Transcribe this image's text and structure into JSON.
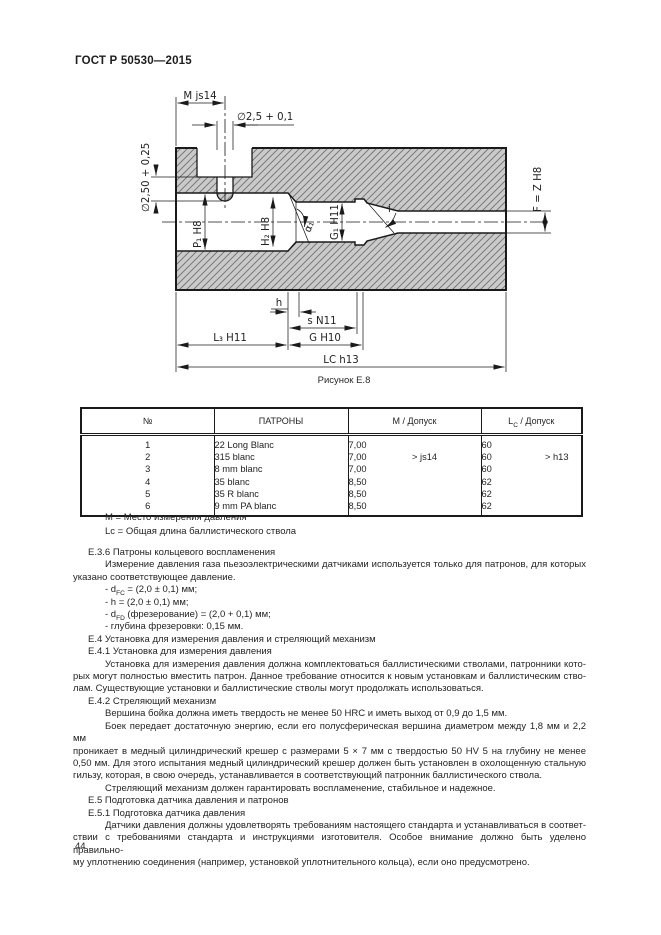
{
  "page": {
    "doc_number": "ГОСТ Р 50530—2015",
    "page_number": "44"
  },
  "figure": {
    "caption": "Рисунок Е.8",
    "labels": {
      "m_js14": "M js14",
      "hole_dia": "∅2,5 + 0,1",
      "depth_dia": "∅2,50 + 0,25",
      "p1": "P₁ H8",
      "h2": "H₂ H8",
      "alpha1": "α₁",
      "g1": "G₁ H11",
      "i": "i",
      "f": "F = Z H8",
      "h": "h",
      "s": "s N11",
      "l3": "L₃ H11",
      "g": "G H10",
      "lc": "LC h13"
    }
  },
  "table": {
    "headers": {
      "num": "№",
      "name": "ПАТРОНЫ",
      "m": "М / Допуск",
      "lc": "L[sub]C[/sub] / Допуск"
    },
    "m_tolerance": "> js14",
    "lc_tolerance": "> h13",
    "rows": [
      {
        "num": "1",
        "name": "22 Long Blanc",
        "m": "7,00",
        "lc": "60"
      },
      {
        "num": "2",
        "name": "315 blanc",
        "m": "7,00",
        "lc": "60"
      },
      {
        "num": "3",
        "name": "8 mm blanc",
        "m": "7,00",
        "lc": "60"
      },
      {
        "num": "4",
        "name": "35 blanc",
        "m": "8,50",
        "lc": "62"
      },
      {
        "num": "5",
        "name": "35 R blanc",
        "m": "8,50",
        "lc": "62"
      },
      {
        "num": "6",
        "name": "9 mm PA blanc",
        "m": "8,50",
        "lc": "62"
      }
    ]
  },
  "legend": {
    "line1": "М  = Место измерения давления",
    "line2": "Lc = Общая длина баллистического ствола"
  },
  "body": {
    "lines": [
      {
        "t": "Е.3.6  Патроны кольцевого воспламенения",
        "i": 1,
        "j": false
      },
      {
        "t": "Измерение давления газа пьезоэлектрическими датчиками используется только для патронов, для которых",
        "i": 2,
        "j": true
      },
      {
        "t": "указано соответствующее давление.",
        "i": 0,
        "j": false
      },
      {
        "t": "- d[sub]FC[/sub] = (2,0 ± 0,1) мм;",
        "i": 2,
        "j": false
      },
      {
        "t": "- h = (2,0 ± 0,1) мм;",
        "i": 2,
        "j": false
      },
      {
        "t": "- d[sub]FD[/sub] (фрезерование) = (2,0 + 0,1) мм;",
        "i": 2,
        "j": false
      },
      {
        "t": "- глубина фрезеровки: 0,15 мм.",
        "i": 2,
        "j": false
      },
      {
        "t": "Е.4  Установка для измерения давления и стреляющий механизм",
        "i": 1,
        "j": false
      },
      {
        "t": "Е.4.1  Установка для измерения давления",
        "i": 1,
        "j": false
      },
      {
        "t": "Установка для измерения давления должна комплектоваться баллистическими стволами, патронники кото-",
        "i": 2,
        "j": true
      },
      {
        "t": "рых могут полностью вместить патрон. Данное требование относится к новым установкам и баллистическим ство-",
        "i": 0,
        "j": true
      },
      {
        "t": "лам. Существующие установки и баллистические стволы могут продолжать использоваться.",
        "i": 0,
        "j": false
      },
      {
        "t": "Е.4.2  Стреляющий механизм",
        "i": 1,
        "j": false
      },
      {
        "t": "Вершина бойка должна иметь твердость не менее 50 HRC и иметь выход от 0,9 до 1,5 мм.",
        "i": 2,
        "j": false
      },
      {
        "t": "Боек передает достаточную энергию, если его полусферическая вершина диаметром между 1,8 мм и 2,2 мм",
        "i": 2,
        "j": true
      },
      {
        "t": "проникает в медный цилиндрический крешер с размерами 5 × 7 мм с твердостью 50 HV 5 на глубину не менее",
        "i": 0,
        "j": true
      },
      {
        "t": "0,50 мм. Для этого испытания медный цилиндрический крешер должен быть установлен в охолощенную стальную",
        "i": 0,
        "j": true
      },
      {
        "t": "гильзу, которая, в свою очередь, устанавливается в соответствующий патронник баллистического ствола.",
        "i": 0,
        "j": false
      },
      {
        "t": "Стреляющий механизм должен гарантировать воспламенение, стабильное и надежное.",
        "i": 2,
        "j": false
      },
      {
        "t": "Е.5  Подготовка датчика давления и патронов",
        "i": 1,
        "j": false
      },
      {
        "t": "Е.5.1  Подготовка датчика давления",
        "i": 1,
        "j": false
      },
      {
        "t": "Датчики давления должны удовлетворять требованиям настоящего стандарта и устанавливаться в соответ-",
        "i": 2,
        "j": true
      },
      {
        "t": "ствии с требованиями стандарта и инструкциями изготовителя. Особое внимание должно быть уделено правильно-",
        "i": 0,
        "j": true
      },
      {
        "t": "му уплотнению соединения (например, установкой уплотнительного кольца), если оно предусмотрено.",
        "i": 0,
        "j": false
      }
    ]
  },
  "colors": {
    "hatch_fill": "#cacaca",
    "hatch_line": "#6f6f6f",
    "ink": "#1a1a1a"
  }
}
